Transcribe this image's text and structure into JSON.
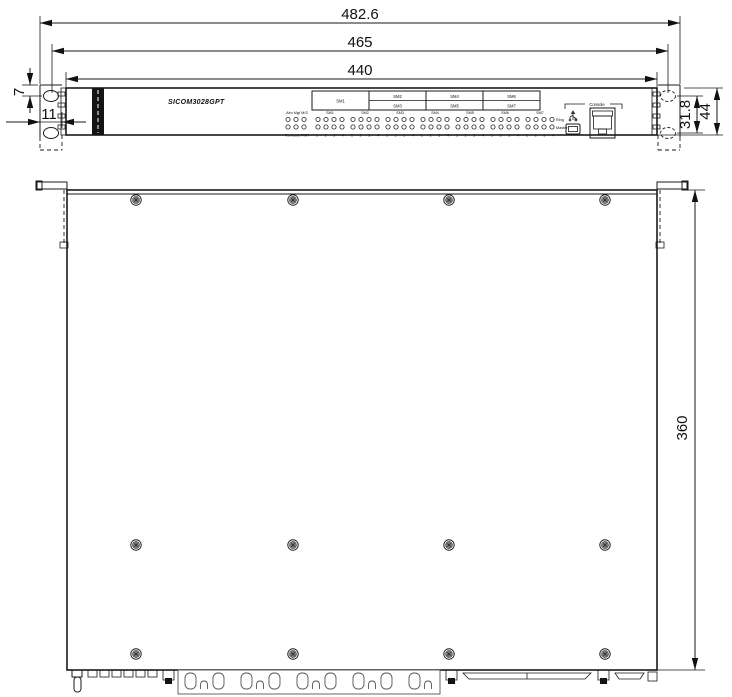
{
  "front": {
    "product_label": "SICOM3028GPT",
    "dim_overall_width": "482.6",
    "dim_mount_width": "465",
    "dim_body_width": "440",
    "dim_ear_offset": "7",
    "dim_ear_width": "11",
    "dim_hole_spacing": "31.8",
    "dim_height": "44",
    "modules": [
      "SM1",
      "SM2",
      "SM3",
      "SM4",
      "SM5",
      "SM6",
      "SM7"
    ],
    "status": {
      "header": "Alm Mgt M/S",
      "footer": "Run Lock PWR"
    },
    "port_numbers": "1 2 3 4",
    "ring_label": "Ring",
    "master_label": "Master",
    "console_label": "Console"
  },
  "top": {
    "dim_depth": "360"
  }
}
